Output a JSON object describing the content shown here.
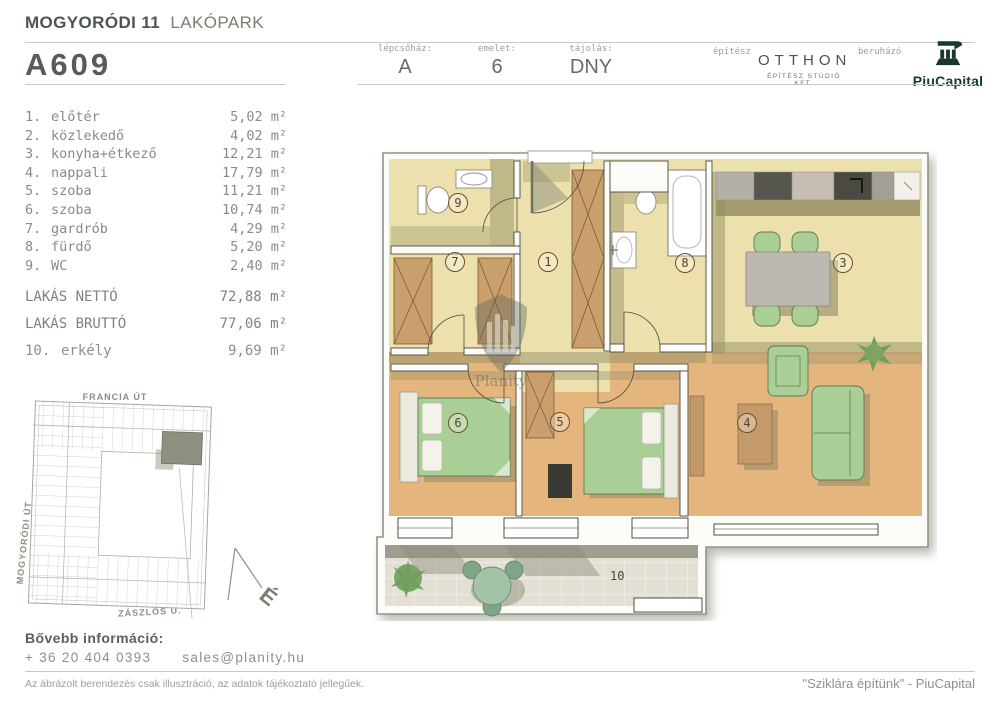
{
  "header": {
    "project_bold": "MOGYORÓDI 11",
    "project_light": "LAKÓPARK",
    "unit_id": "A609",
    "fields": [
      {
        "label": "lépcsőház:",
        "value": "A"
      },
      {
        "label": "emelet:",
        "value": "6"
      },
      {
        "label": "tájolás:",
        "value": "DNY"
      }
    ],
    "architect_label": "építész",
    "architect_name": "OTTHON",
    "architect_sub": "ÉPÍTÉSZ STÚDIÓ KFT.",
    "developer_label": "beruházó",
    "developer_name": "PiuCapital"
  },
  "rooms": [
    {
      "num": "1.",
      "name": "előtér",
      "area": "5,02 m²"
    },
    {
      "num": "2.",
      "name": "közlekedő",
      "area": "4,02 m²"
    },
    {
      "num": "3.",
      "name": "konyha+étkező",
      "area": "12,21 m²"
    },
    {
      "num": "4.",
      "name": "nappali",
      "area": "17,79 m²"
    },
    {
      "num": "5.",
      "name": "szoba",
      "area": "11,21 m²"
    },
    {
      "num": "6.",
      "name": "szoba",
      "area": "10,74 m²"
    },
    {
      "num": "7.",
      "name": "gardrób",
      "area": "4,29 m²"
    },
    {
      "num": "8.",
      "name": "fürdő",
      "area": "5,20 m²"
    },
    {
      "num": "9.",
      "name": "WC",
      "area": "2,40 m²"
    }
  ],
  "totals": {
    "net_label": "LAKÁS NETTÓ",
    "net_area": "72,88 m²",
    "gross_label": "LAKÁS BRUTTÓ",
    "gross_area": "77,06 m²",
    "balcony_num": "10.",
    "balcony_name": "erkély",
    "balcony_area": "9,69 m²"
  },
  "site_map": {
    "street_top": "FRANCIA ÚT",
    "street_left": "MOGYORÓDI ÚT",
    "street_bottom": "ZÁSZLÓS U.",
    "north_label": "É"
  },
  "floor_plan": {
    "watermark": "Planity",
    "labels": {
      "r1": "1",
      "r3": "3",
      "r4": "4",
      "r5": "5",
      "r6": "6",
      "r7": "7",
      "r8": "8",
      "r9": "9",
      "r10": "10"
    }
  },
  "footer": {
    "info_title": "Bővebb információ:",
    "phone": "+ 36 20 404 0393",
    "email": "sales@planity.hu",
    "disclaimer": "Az ábrázolt berendezés csak illusztráció, az adatok tájékoztató jellegűek.",
    "quote": "\"Sziklára építünk\" - PiuCapital"
  },
  "colors": {
    "brand_green": "#17382a",
    "floor_pale": "#ece0ad",
    "floor_wood": "#e4b67e",
    "shadow_olive": "#968f66",
    "furniture_green": "#a9ce96",
    "wardrobe_brown": "#c99f6d",
    "balcony_tile": "#e3dfd5",
    "text_gray_green": "#868e80"
  }
}
